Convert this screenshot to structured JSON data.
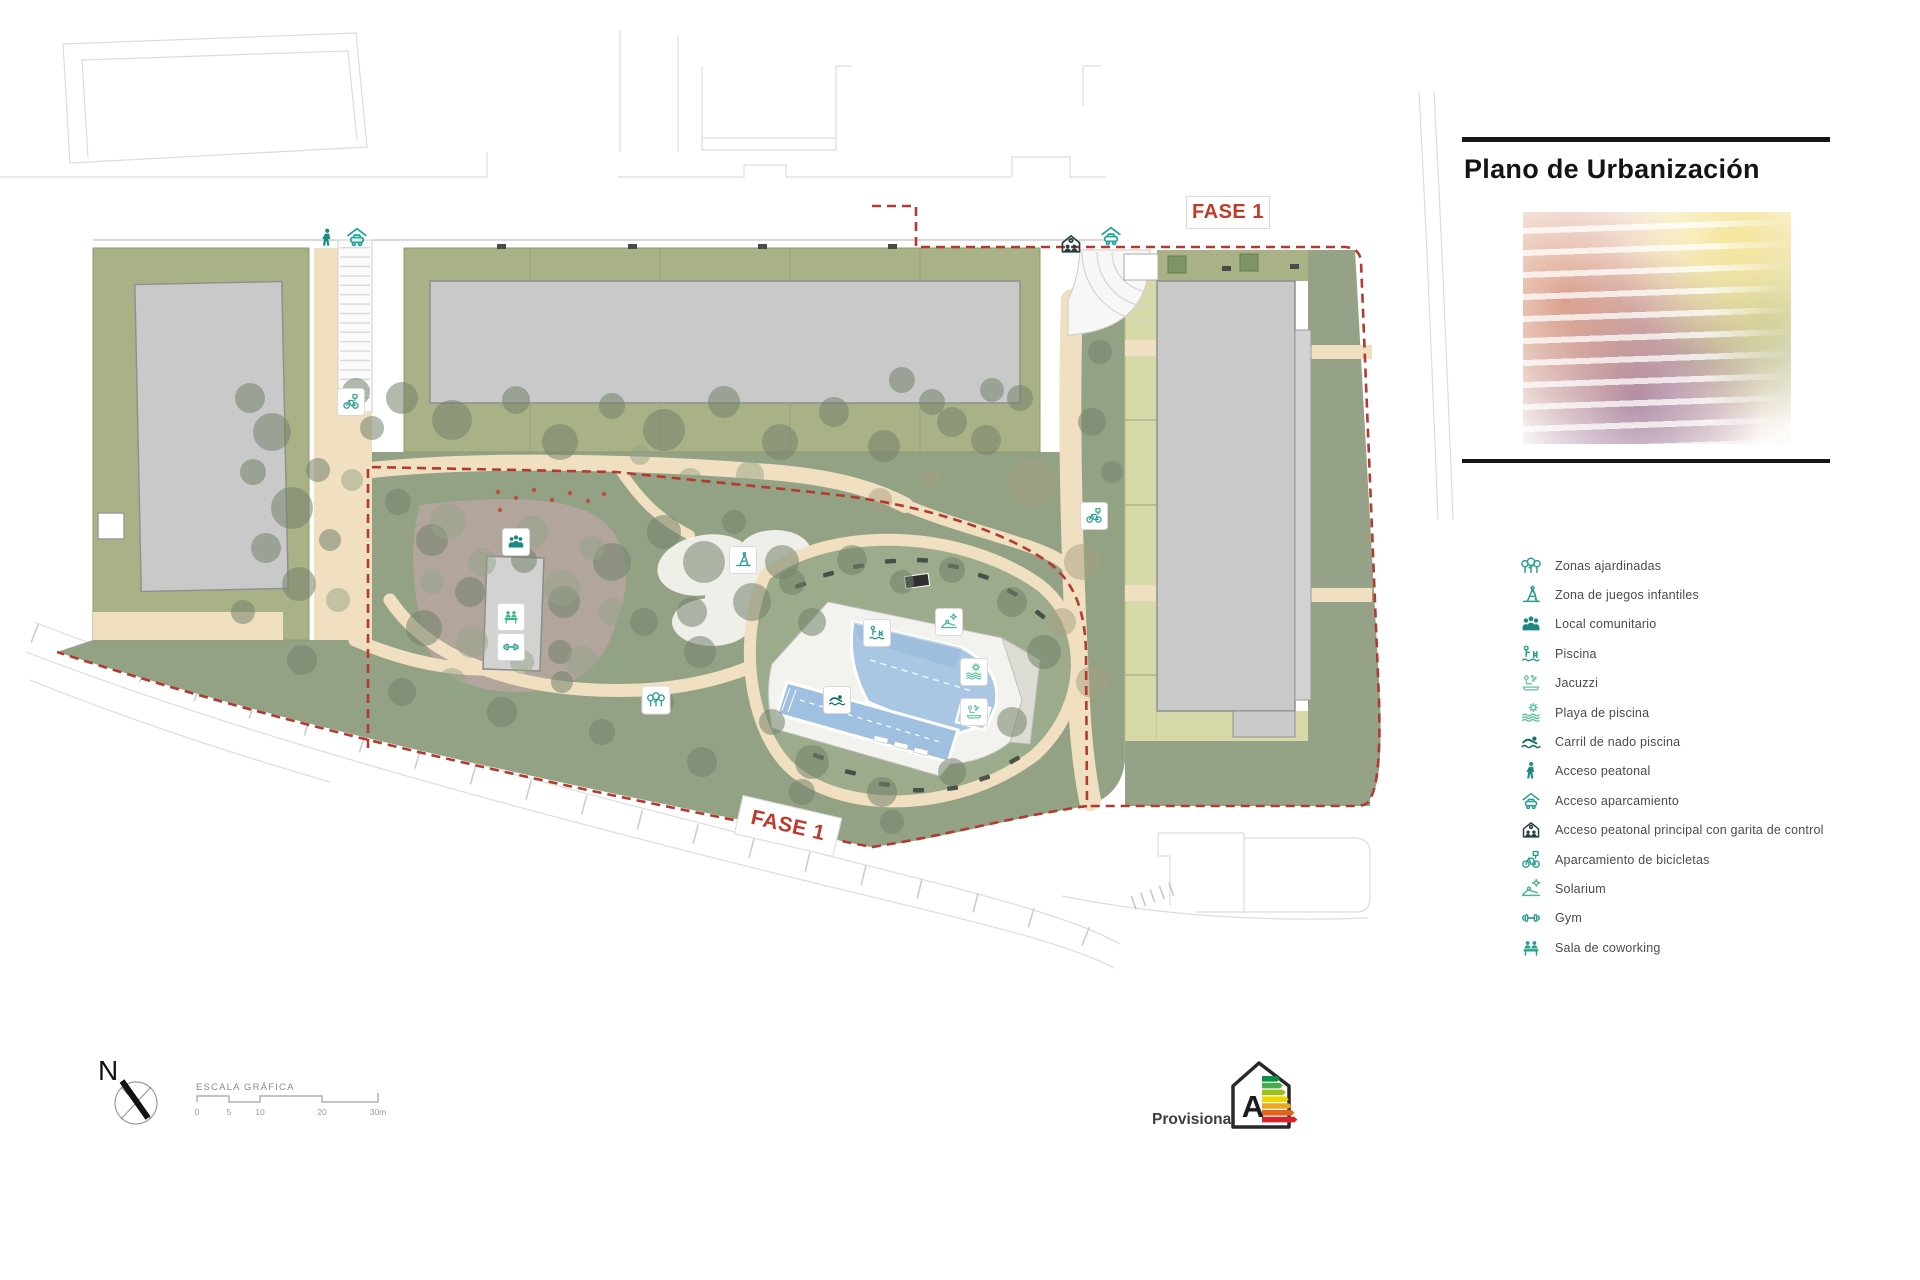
{
  "title": "Plano de Urbanización",
  "phase_labels": {
    "top": "FASE 1",
    "bottom": "FASE 1"
  },
  "legend": {
    "items": [
      {
        "icon": "trees-icon",
        "label": "Zonas ajardinadas",
        "color": "#2a9d8f"
      },
      {
        "icon": "playground-icon",
        "label": "Zona de juegos infantiles",
        "color": "#2a9d8f"
      },
      {
        "icon": "people-icon",
        "label": "Local comunitario",
        "color": "#1b8a80"
      },
      {
        "icon": "piscina-icon",
        "label": "Piscina",
        "color": "#2a9d8f"
      },
      {
        "icon": "jacuzzi-icon",
        "label": "Jacuzzi",
        "color": "#79c9ac"
      },
      {
        "icon": "sun-waves-icon",
        "label": "Playa de piscina",
        "color": "#5bbfa0"
      },
      {
        "icon": "swimmer-icon",
        "label": "Carril de nado piscina",
        "color": "#156f68"
      },
      {
        "icon": "pedestrian-icon",
        "label": "Acceso peatonal",
        "color": "#1b8a80"
      },
      {
        "icon": "car-roof-icon",
        "label": "Acceso aparcamiento",
        "color": "#2a9d8f"
      },
      {
        "icon": "garita-icon",
        "label": "Acceso peatonal principal con garita de control",
        "color": "#223f3a"
      },
      {
        "icon": "bicycle-icon",
        "label": "Aparcamiento de bicicletas",
        "color": "#2a9d8f"
      },
      {
        "icon": "solarium-icon",
        "label": "Solarium",
        "color": "#4db39a"
      },
      {
        "icon": "gym-icon",
        "label": "Gym",
        "color": "#2a9d8f"
      },
      {
        "icon": "coworking-icon",
        "label": "Sala de coworking",
        "color": "#27a08c"
      }
    ]
  },
  "map_badges": [
    {
      "icon": "playground-icon",
      "x": 743,
      "y": 560,
      "boxed": true,
      "size": 19,
      "color": "#2a9d8f"
    },
    {
      "icon": "piscina-icon",
      "x": 877,
      "y": 633,
      "boxed": true,
      "size": 19,
      "color": "#2a9d8f"
    },
    {
      "icon": "solarium-icon",
      "x": 949,
      "y": 622,
      "boxed": true,
      "size": 19,
      "color": "#4db39a"
    },
    {
      "icon": "sun-waves-icon",
      "x": 974,
      "y": 672,
      "boxed": true,
      "size": 19,
      "color": "#5bbfa0"
    },
    {
      "icon": "jacuzzi-icon",
      "x": 974,
      "y": 712,
      "boxed": true,
      "size": 19,
      "color": "#79c9ac"
    },
    {
      "icon": "swimmer-icon",
      "x": 837,
      "y": 700,
      "boxed": true,
      "size": 19,
      "color": "#156f68"
    },
    {
      "icon": "people-icon",
      "x": 516,
      "y": 542,
      "boxed": true,
      "size": 19,
      "color": "#1b8a80"
    },
    {
      "icon": "coworking-icon",
      "x": 511,
      "y": 617,
      "boxed": true,
      "size": 19,
      "color": "#34b88a"
    },
    {
      "icon": "gym-icon",
      "x": 511,
      "y": 647,
      "boxed": true,
      "size": 19,
      "color": "#2a9d8f"
    },
    {
      "icon": "bicycle-icon",
      "x": 351,
      "y": 402,
      "boxed": true,
      "size": 19,
      "color": "#2a9d8f"
    },
    {
      "icon": "bicycle-icon",
      "x": 1094,
      "y": 516,
      "boxed": true,
      "size": 19,
      "color": "#2a9d8f"
    },
    {
      "icon": "trees-icon",
      "x": 656,
      "y": 700,
      "boxed": true,
      "size": 20,
      "color": "#2a9d8f"
    },
    {
      "icon": "pedestrian-icon",
      "x": 327,
      "y": 238,
      "boxed": false,
      "size": 23,
      "color": "#1b8a80"
    },
    {
      "icon": "car-roof-icon",
      "x": 357,
      "y": 237,
      "boxed": false,
      "size": 25,
      "color": "#19a396"
    },
    {
      "icon": "garita-icon",
      "x": 1071,
      "y": 244,
      "boxed": false,
      "size": 25,
      "color": "#223f3a"
    },
    {
      "icon": "car-roof-icon",
      "x": 1111,
      "y": 236,
      "boxed": false,
      "size": 25,
      "color": "#19a396"
    }
  ],
  "compass": {
    "north_label": "N"
  },
  "scale_bar": {
    "label": "ESCALA GRÁFICA",
    "ticks": [
      "0",
      "5",
      "10",
      "20",
      "30m"
    ]
  },
  "energy_rating": {
    "label": "Provisional",
    "grade": "A",
    "colors": [
      "#0e8f44",
      "#45ac49",
      "#9cc21d",
      "#f2d500",
      "#efa71c",
      "#e4641d",
      "#d8232a"
    ]
  },
  "colors": {
    "boundary_red": "#b23a31",
    "accent_teal": "#2a9d8f",
    "building_gray": "#c9c9c9",
    "garden_green": "#93a285",
    "band_olive": "#a9b287",
    "band_khaki": "#d8d9a9",
    "sand_path": "#f0dfc0",
    "plaza_mauve": "#b3a59d",
    "pool_blue": "#a9c6e3"
  }
}
